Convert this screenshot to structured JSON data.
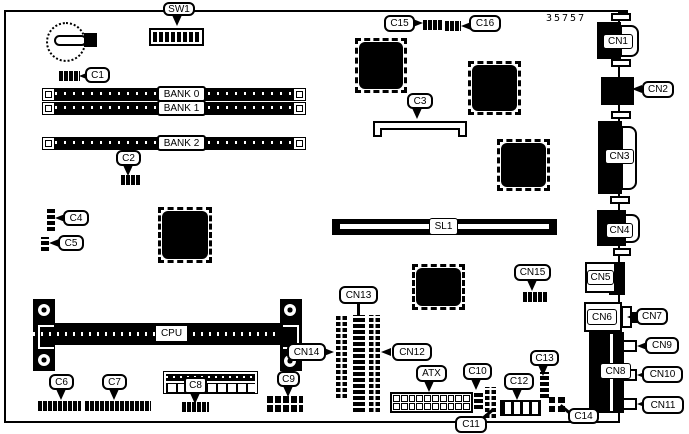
{
  "board": {
    "part_number": "35757",
    "labels": {
      "sw1": "SW1",
      "c1": "C1",
      "c2": "C2",
      "c3": "C3",
      "c4": "C4",
      "c5": "C5",
      "c6": "C6",
      "c7": "C7",
      "c8": "C8",
      "c9": "C9",
      "c10": "C10",
      "c11": "C11",
      "c12": "C12",
      "c13": "C13",
      "c14": "C14",
      "c15": "C15",
      "c16": "C16",
      "cn1": "CN1",
      "cn2": "CN2",
      "cn3": "CN3",
      "cn4": "CN4",
      "cn5": "CN5",
      "cn6": "CN6",
      "cn7": "CN7",
      "cn8": "CN8",
      "cn9": "CN9",
      "cn10": "CN10",
      "cn11": "CN11",
      "cn12": "CN12",
      "cn13": "CN13",
      "cn14": "CN14",
      "cn15": "CN15",
      "bank0": "BANK 0",
      "bank1": "BANK 1",
      "bank2": "BANK 2",
      "cpu": "CPU",
      "sl1": "SL1",
      "atx": "ATX"
    },
    "colors": {
      "line": "#000000",
      "background": "#ffffff"
    }
  }
}
